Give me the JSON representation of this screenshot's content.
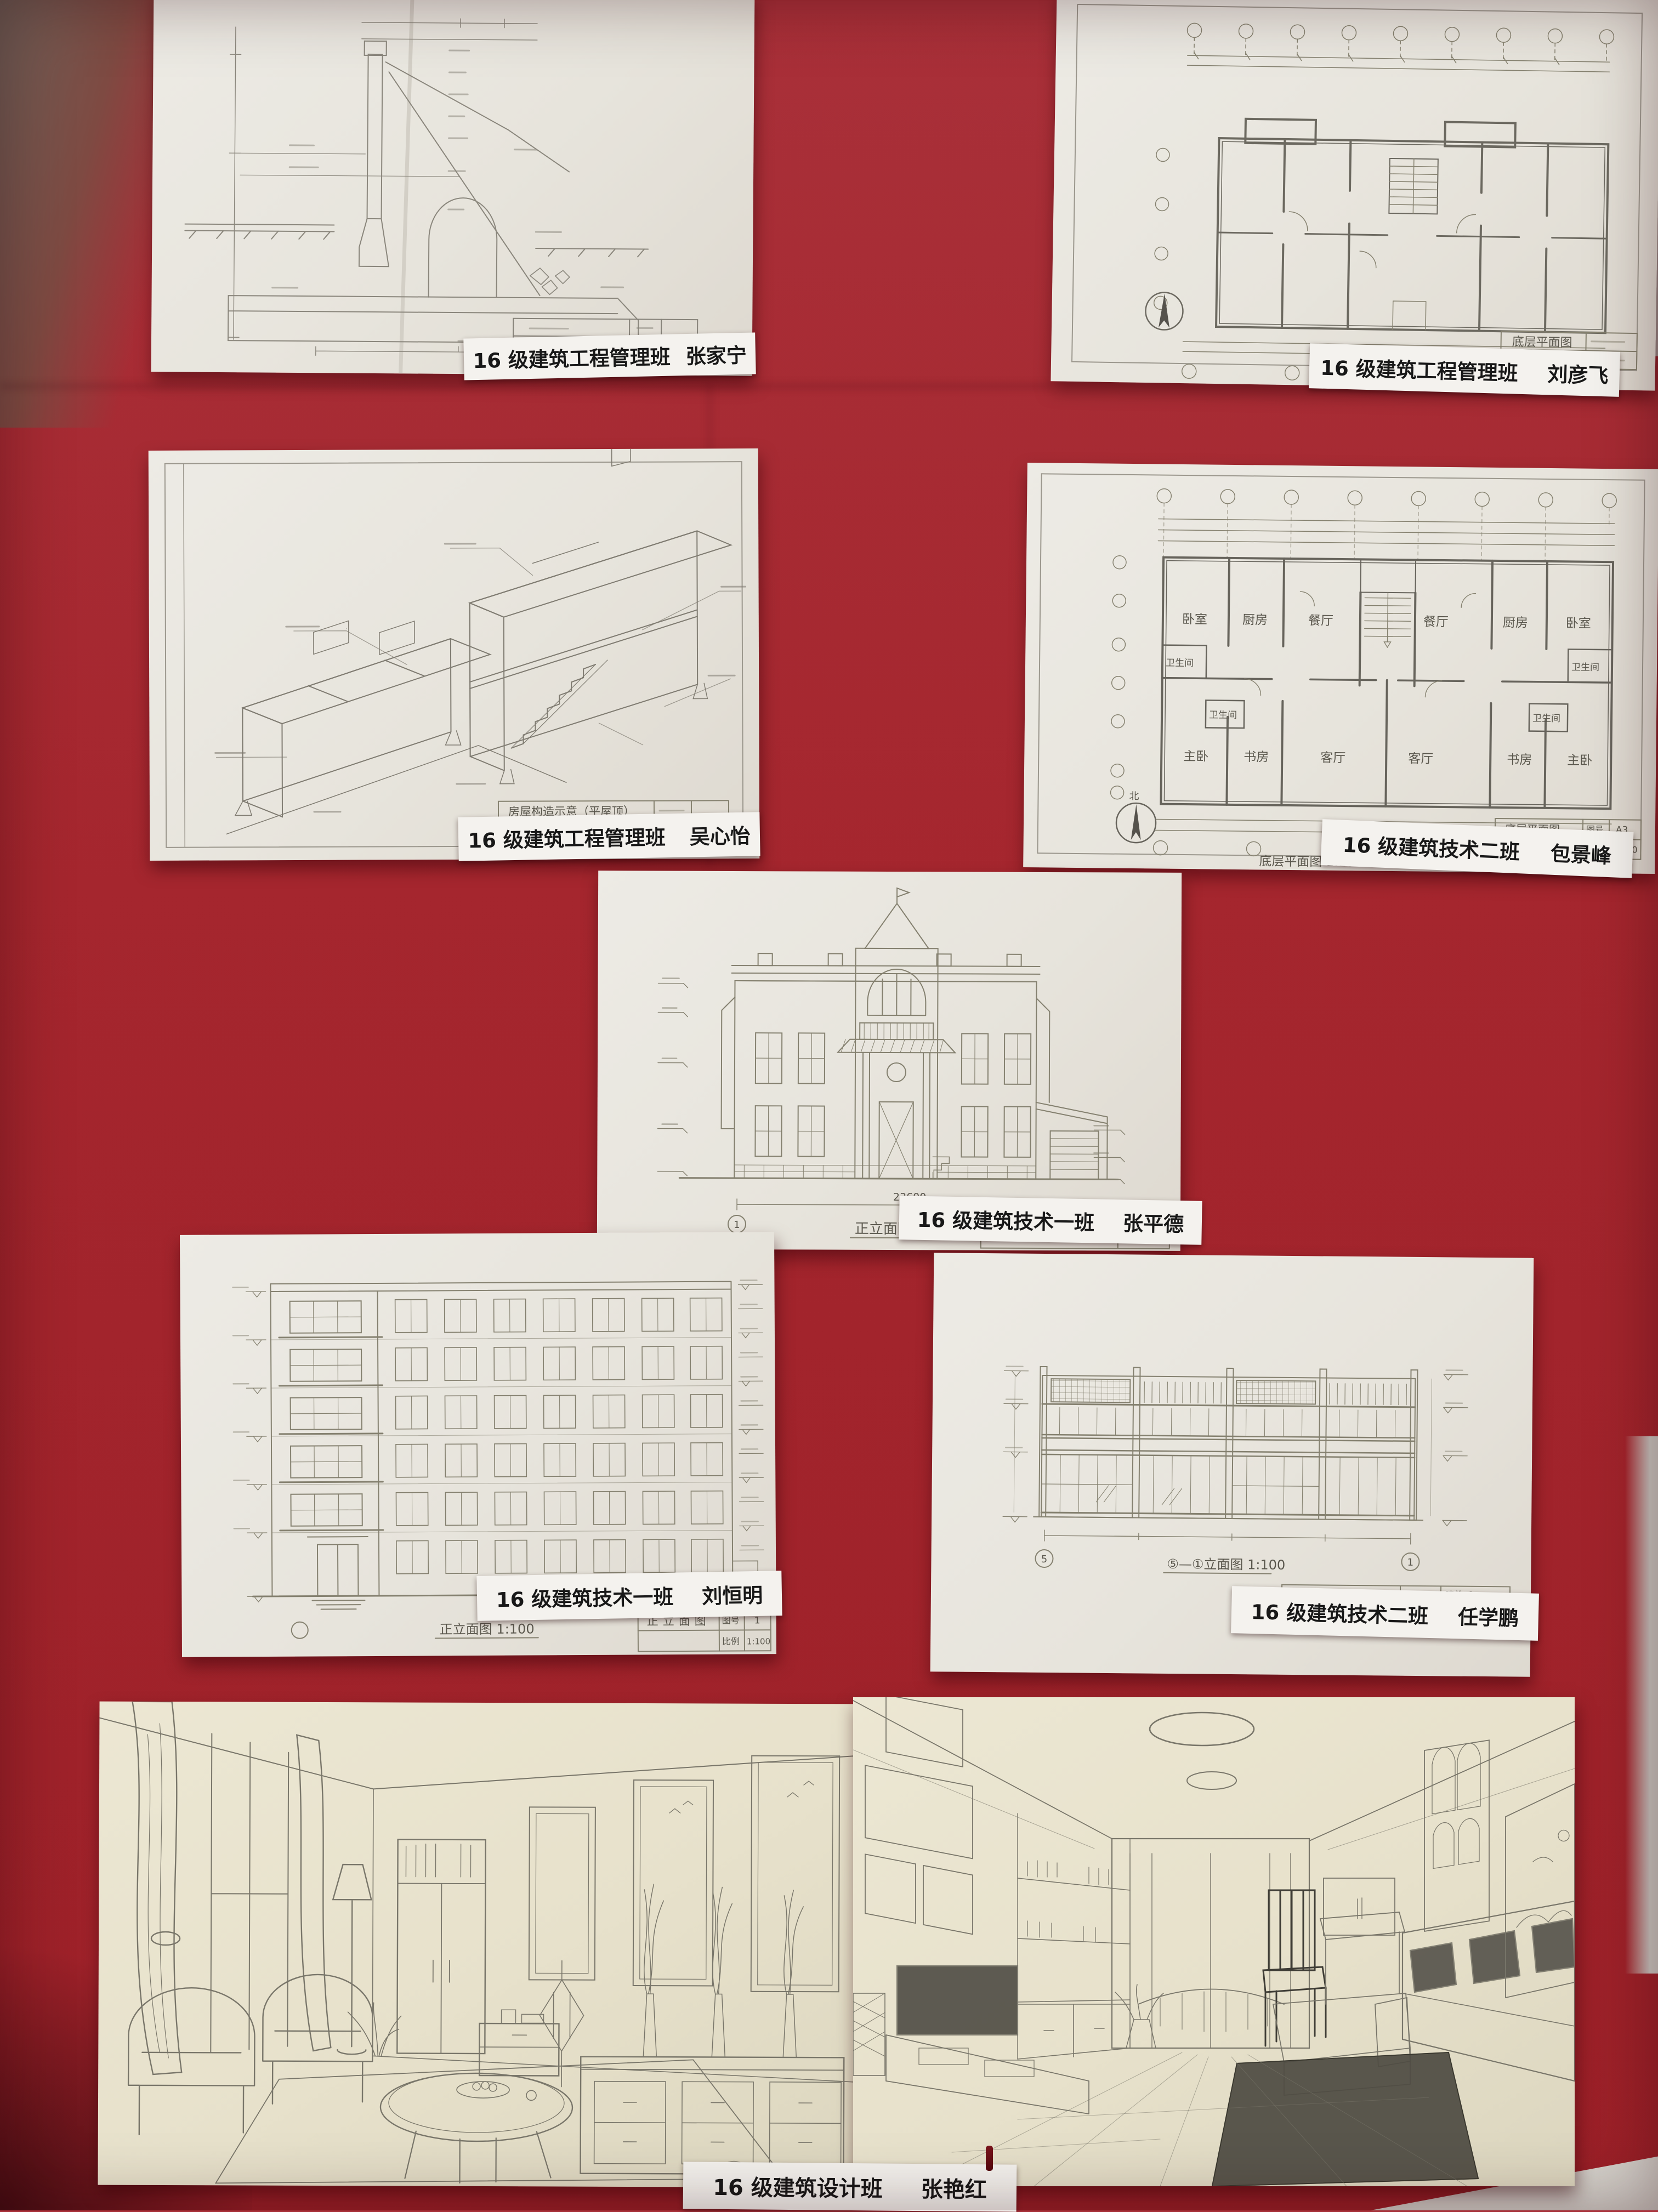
{
  "board": {
    "type": "red fabric display board with pinned student drawings",
    "red_color": "#a5262e",
    "paper_color": "#e9e6df",
    "sketch_paper_color": "#e9e4cf"
  },
  "sheets": [
    {
      "id": "retaining-structure-section",
      "class_label": "16 级建筑工程管理班",
      "student_name": "张家宁"
    },
    {
      "id": "ground-floor-plan",
      "class_label": "16 级建筑工程管理班",
      "student_name": "刘彦飞",
      "title_block_title": "底层平面图",
      "caption": "底层平面图"
    },
    {
      "id": "house-structure-axonometric",
      "class_label": "16 级建筑工程管理班",
      "student_name": "吴心怡",
      "title_block_title": "房屋构造示意（平屋顶）"
    },
    {
      "id": "unit-floor-plan",
      "class_label": "16 级建筑技术二班",
      "student_name": "包景峰",
      "title_block_title": "底层平面图",
      "sheet_no_label": "图号",
      "sheet_no": "A3",
      "scale_label": "比例",
      "scale": "1:100",
      "caption": "底层平面图 1:100",
      "overall_dimension": "23640",
      "north_label": "北",
      "rooms": {
        "bedroom": "卧室",
        "kitchen": "厨房",
        "dining": "餐厅",
        "bath": "卫生间",
        "master": "主卧",
        "study": "书房",
        "living": "客厅"
      }
    },
    {
      "id": "villa-front-elevation",
      "class_label": "16 级建筑技术一班",
      "student_name": "张平德",
      "caption": "正立面图",
      "title_block_title": "正立面图",
      "overall_dimension": "23600",
      "axis_start": "1",
      "axis_end": "7"
    },
    {
      "id": "six-storey-elevation",
      "class_label": "16 级建筑技术一班",
      "student_name": "刘恒明",
      "caption": "正立面图 1:100",
      "title_block_title": "正立面图",
      "sheet_no_label": "图号",
      "sheet_no": "1",
      "scale_label": "比例",
      "scale": "1:100"
    },
    {
      "id": "storefront-elevation",
      "class_label": "16 级建筑技术二班",
      "student_name": "任学鹏",
      "caption": "⑤—①立面图 1:100",
      "title_block_title": "⑤—①立面图",
      "sheet_no_label": "图号",
      "sheet_no": "建施-6",
      "scale_label": "比例",
      "scale": "1:100",
      "axis_start": "5",
      "axis_end": "1"
    },
    {
      "id": "interior-perspective-pair",
      "class_label": "16 级建筑设计班",
      "student_name": "张艳红"
    }
  ]
}
